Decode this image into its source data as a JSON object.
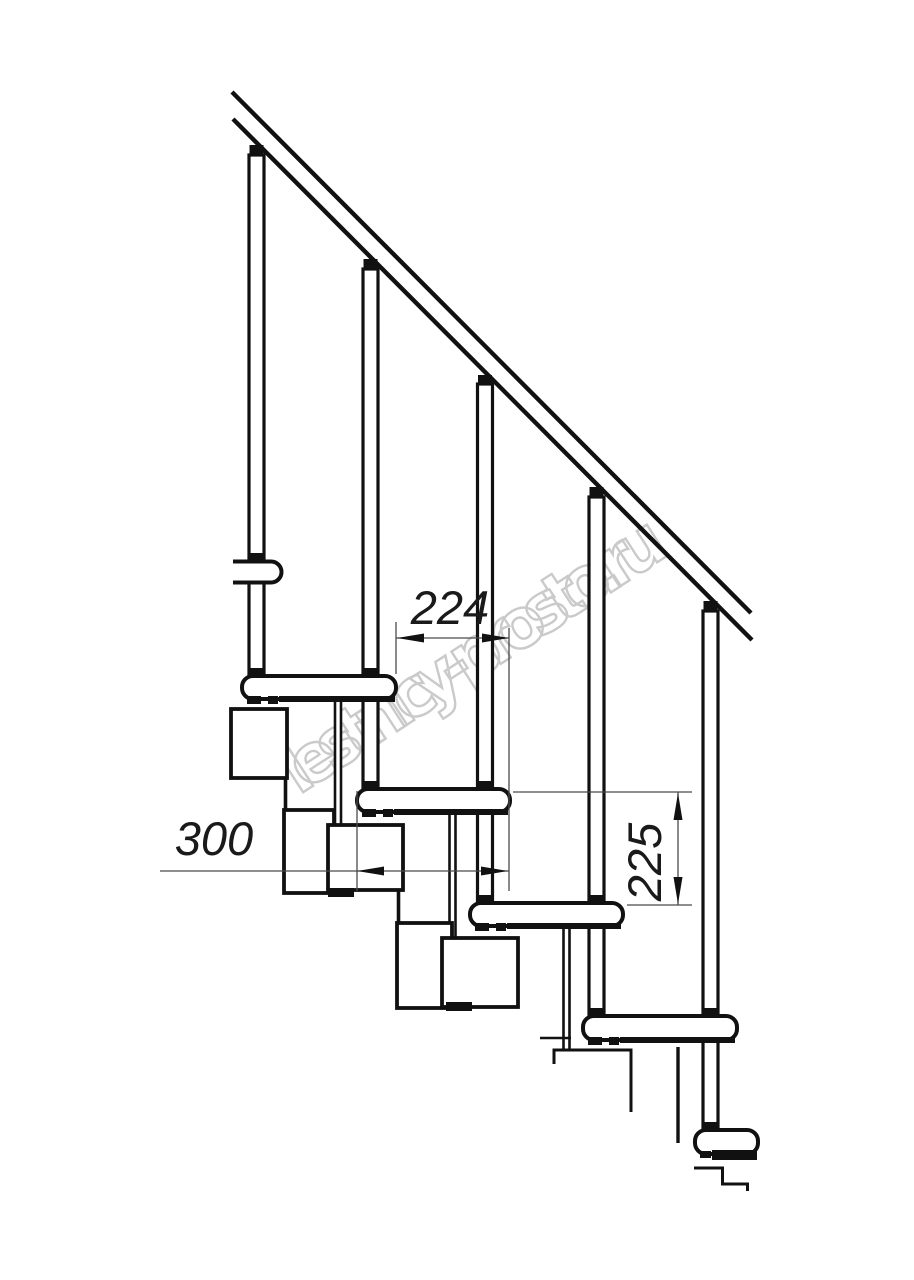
{
  "drawing": {
    "watermark": {
      "text": "lestnicy-prosto.ru",
      "color": "#c5c5c5"
    },
    "dimensions": {
      "going": {
        "value": "224"
      },
      "tread_depth": {
        "value": "300"
      },
      "riser_height": {
        "value": "225"
      }
    },
    "colors": {
      "background": "#ffffff",
      "line": "#111111",
      "dimension_line": "#4a4a4a",
      "watermark_stroke": "#c5c5c5"
    }
  }
}
